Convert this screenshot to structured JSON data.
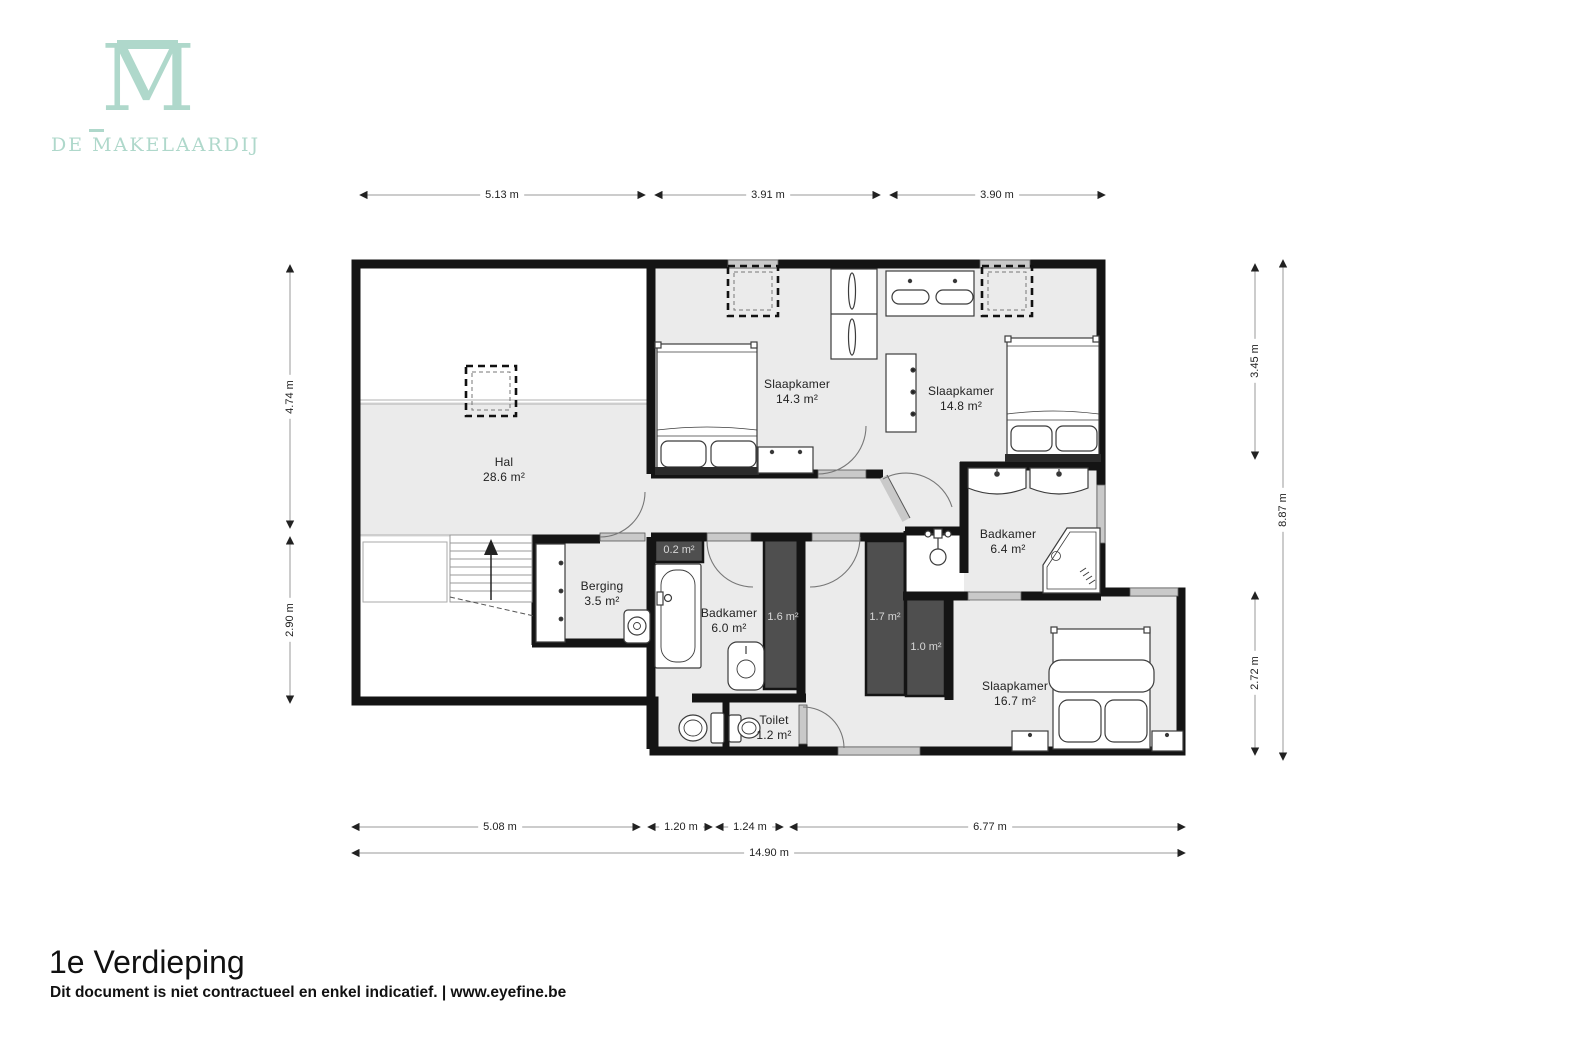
{
  "logo": {
    "monogram": "M",
    "wordmark": "DE MAKELAARDIJ",
    "color": "#afd8cb"
  },
  "plan": {
    "rooms": [
      {
        "id": "hal",
        "name": "Hal",
        "area": "28.6 m²"
      },
      {
        "id": "slaapkamer-1",
        "name": "Slaapkamer",
        "area": "14.3 m²"
      },
      {
        "id": "slaapkamer-2",
        "name": "Slaapkamer",
        "area": "14.8 m²"
      },
      {
        "id": "badkamer-1",
        "name": "Badkamer",
        "area": "6.4 m²"
      },
      {
        "id": "berging",
        "name": "Berging",
        "area": "3.5 m²"
      },
      {
        "id": "badkamer-2",
        "name": "Badkamer",
        "area": "6.0 m²"
      },
      {
        "id": "toilet",
        "name": "Toilet",
        "area": "1.2 m²"
      },
      {
        "id": "slaapkamer-3",
        "name": "Slaapkamer",
        "area": "16.7 m²"
      }
    ],
    "closets": [
      {
        "area": "0.2 m²"
      },
      {
        "area": "1.6 m²"
      },
      {
        "area": "1.7 m²"
      },
      {
        "area": "1.0 m²"
      }
    ],
    "dimensions": {
      "top": [
        "5.13 m",
        "3.91 m",
        "3.90 m"
      ],
      "left": [
        "4.74 m",
        "2.90 m"
      ],
      "right": [
        "3.45 m",
        "2.72 m",
        "8.87 m"
      ],
      "bottom": [
        "5.08 m",
        "1.20 m",
        "1.24 m",
        "6.77 m"
      ],
      "total_width": "14.90 m"
    }
  },
  "footer": {
    "title": "1e Verdieping",
    "disclaimer": "Dit document is niet contractueel en enkel indicatief. | www.eyefine.be"
  }
}
